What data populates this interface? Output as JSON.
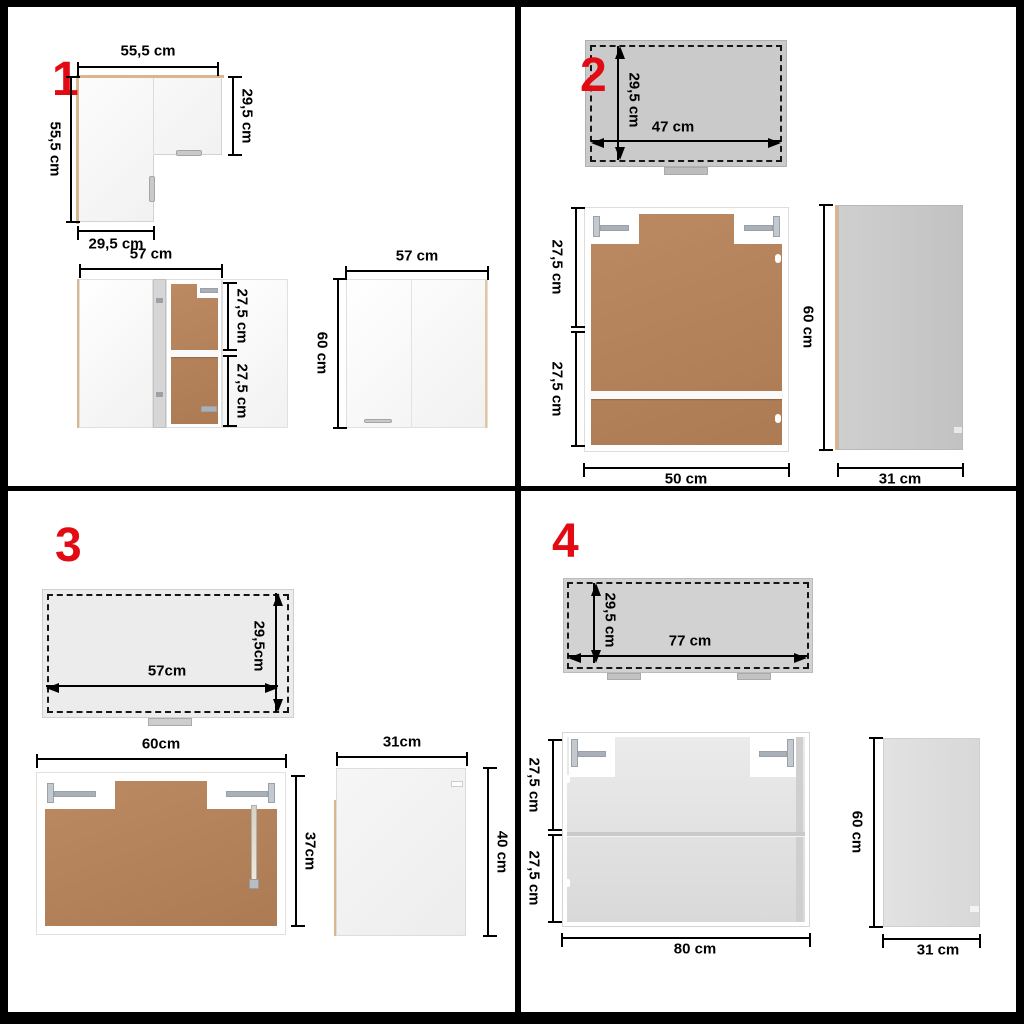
{
  "figure": {
    "type": "kitchen-cabinet-set-dimension-diagram",
    "units": "cm"
  },
  "colors": {
    "red": "#e30b13",
    "wood": "#b3815a",
    "tan": "#d9b68d"
  },
  "q1": {
    "number": "1",
    "corner_top_view": {
      "width_top": "55,5 cm",
      "depth_right": "29,5 cm",
      "height_left": "55,5 cm",
      "width_bottom": "29,5 cm"
    },
    "open_cabinet": {
      "width": "57 cm",
      "upper_shelf": "27,5 cm",
      "lower_shelf": "27,5 cm"
    },
    "closed_cabinet": {
      "width": "57 cm",
      "height": "60 cm"
    }
  },
  "q2": {
    "number": "2",
    "top_view": {
      "depth": "29,5 cm",
      "width": "47 cm"
    },
    "front_view": {
      "upper_shelf": "27,5 cm",
      "lower_shelf": "27,5 cm",
      "width": "50 cm"
    },
    "side_view": {
      "height": "60 cm",
      "depth": "31 cm"
    }
  },
  "q3": {
    "number": "3",
    "top_view": {
      "width": "57cm",
      "depth": "29,5cm"
    },
    "front_view": {
      "width": "60cm",
      "height": "37cm"
    },
    "side_view": {
      "depth": "31cm",
      "height": "40 cm"
    }
  },
  "q4": {
    "number": "4",
    "top_view": {
      "depth": "29,5 cm",
      "width": "77 cm"
    },
    "front_view": {
      "upper_shelf": "27,5 cm",
      "lower_shelf": "27,5 cm",
      "width": "80 cm"
    },
    "side_view": {
      "height": "60 cm",
      "depth": "31 cm"
    }
  }
}
